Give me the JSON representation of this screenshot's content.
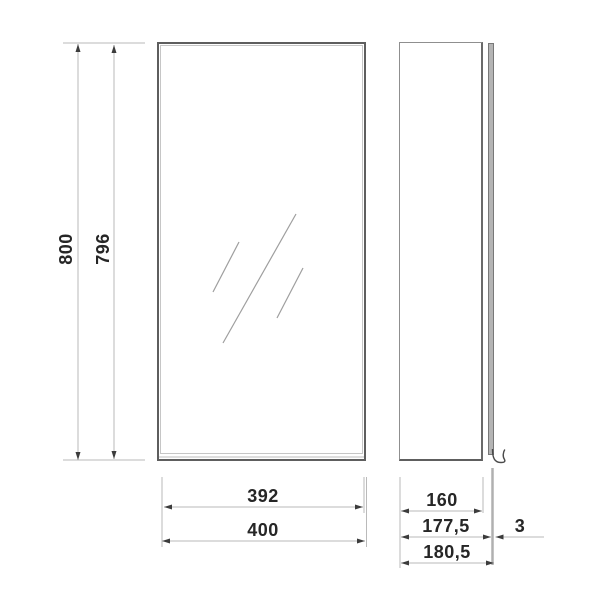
{
  "front_view": {
    "height_total": "800",
    "height_door": "796",
    "width_door": "392",
    "width_total": "400"
  },
  "side_view": {
    "depth_body": "160",
    "depth_without_glass": "177,5",
    "glass_thickness": "3",
    "depth_total": "180,5"
  },
  "colors": {
    "background": "#ffffff",
    "outline_dark": "#5e5e5e",
    "dimension_line": "#bababa",
    "arrowhead": "#3c3c3c",
    "label_text": "#262626",
    "mirror_fill": "#b4b4b4",
    "glint_line": "#9e9e9e"
  }
}
